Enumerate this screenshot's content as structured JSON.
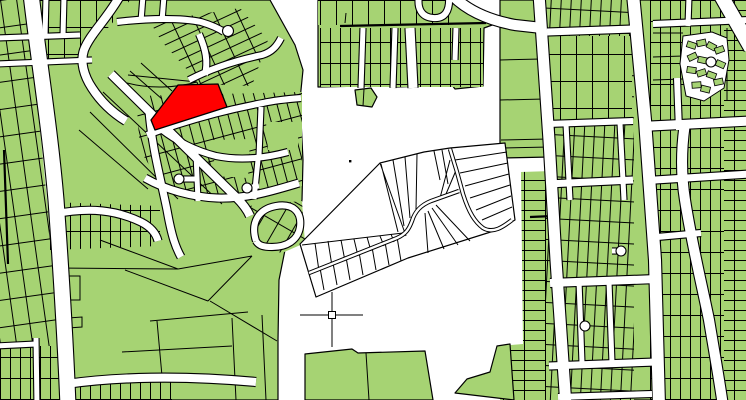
{
  "colors": {
    "background": "#FFFFFF",
    "parcel_fill": "#A6D373",
    "parcel_outline": "#000000",
    "road_fill": "#FFFFFF",
    "highlight_fill": "#FF0000"
  },
  "highlight_parcel": {
    "points": "178,85 218,84 227,107 155,130 151,120"
  },
  "marker": {
    "transform": "translate(332,315)"
  },
  "reference_point": {
    "transform": "translate(350,161)"
  }
}
